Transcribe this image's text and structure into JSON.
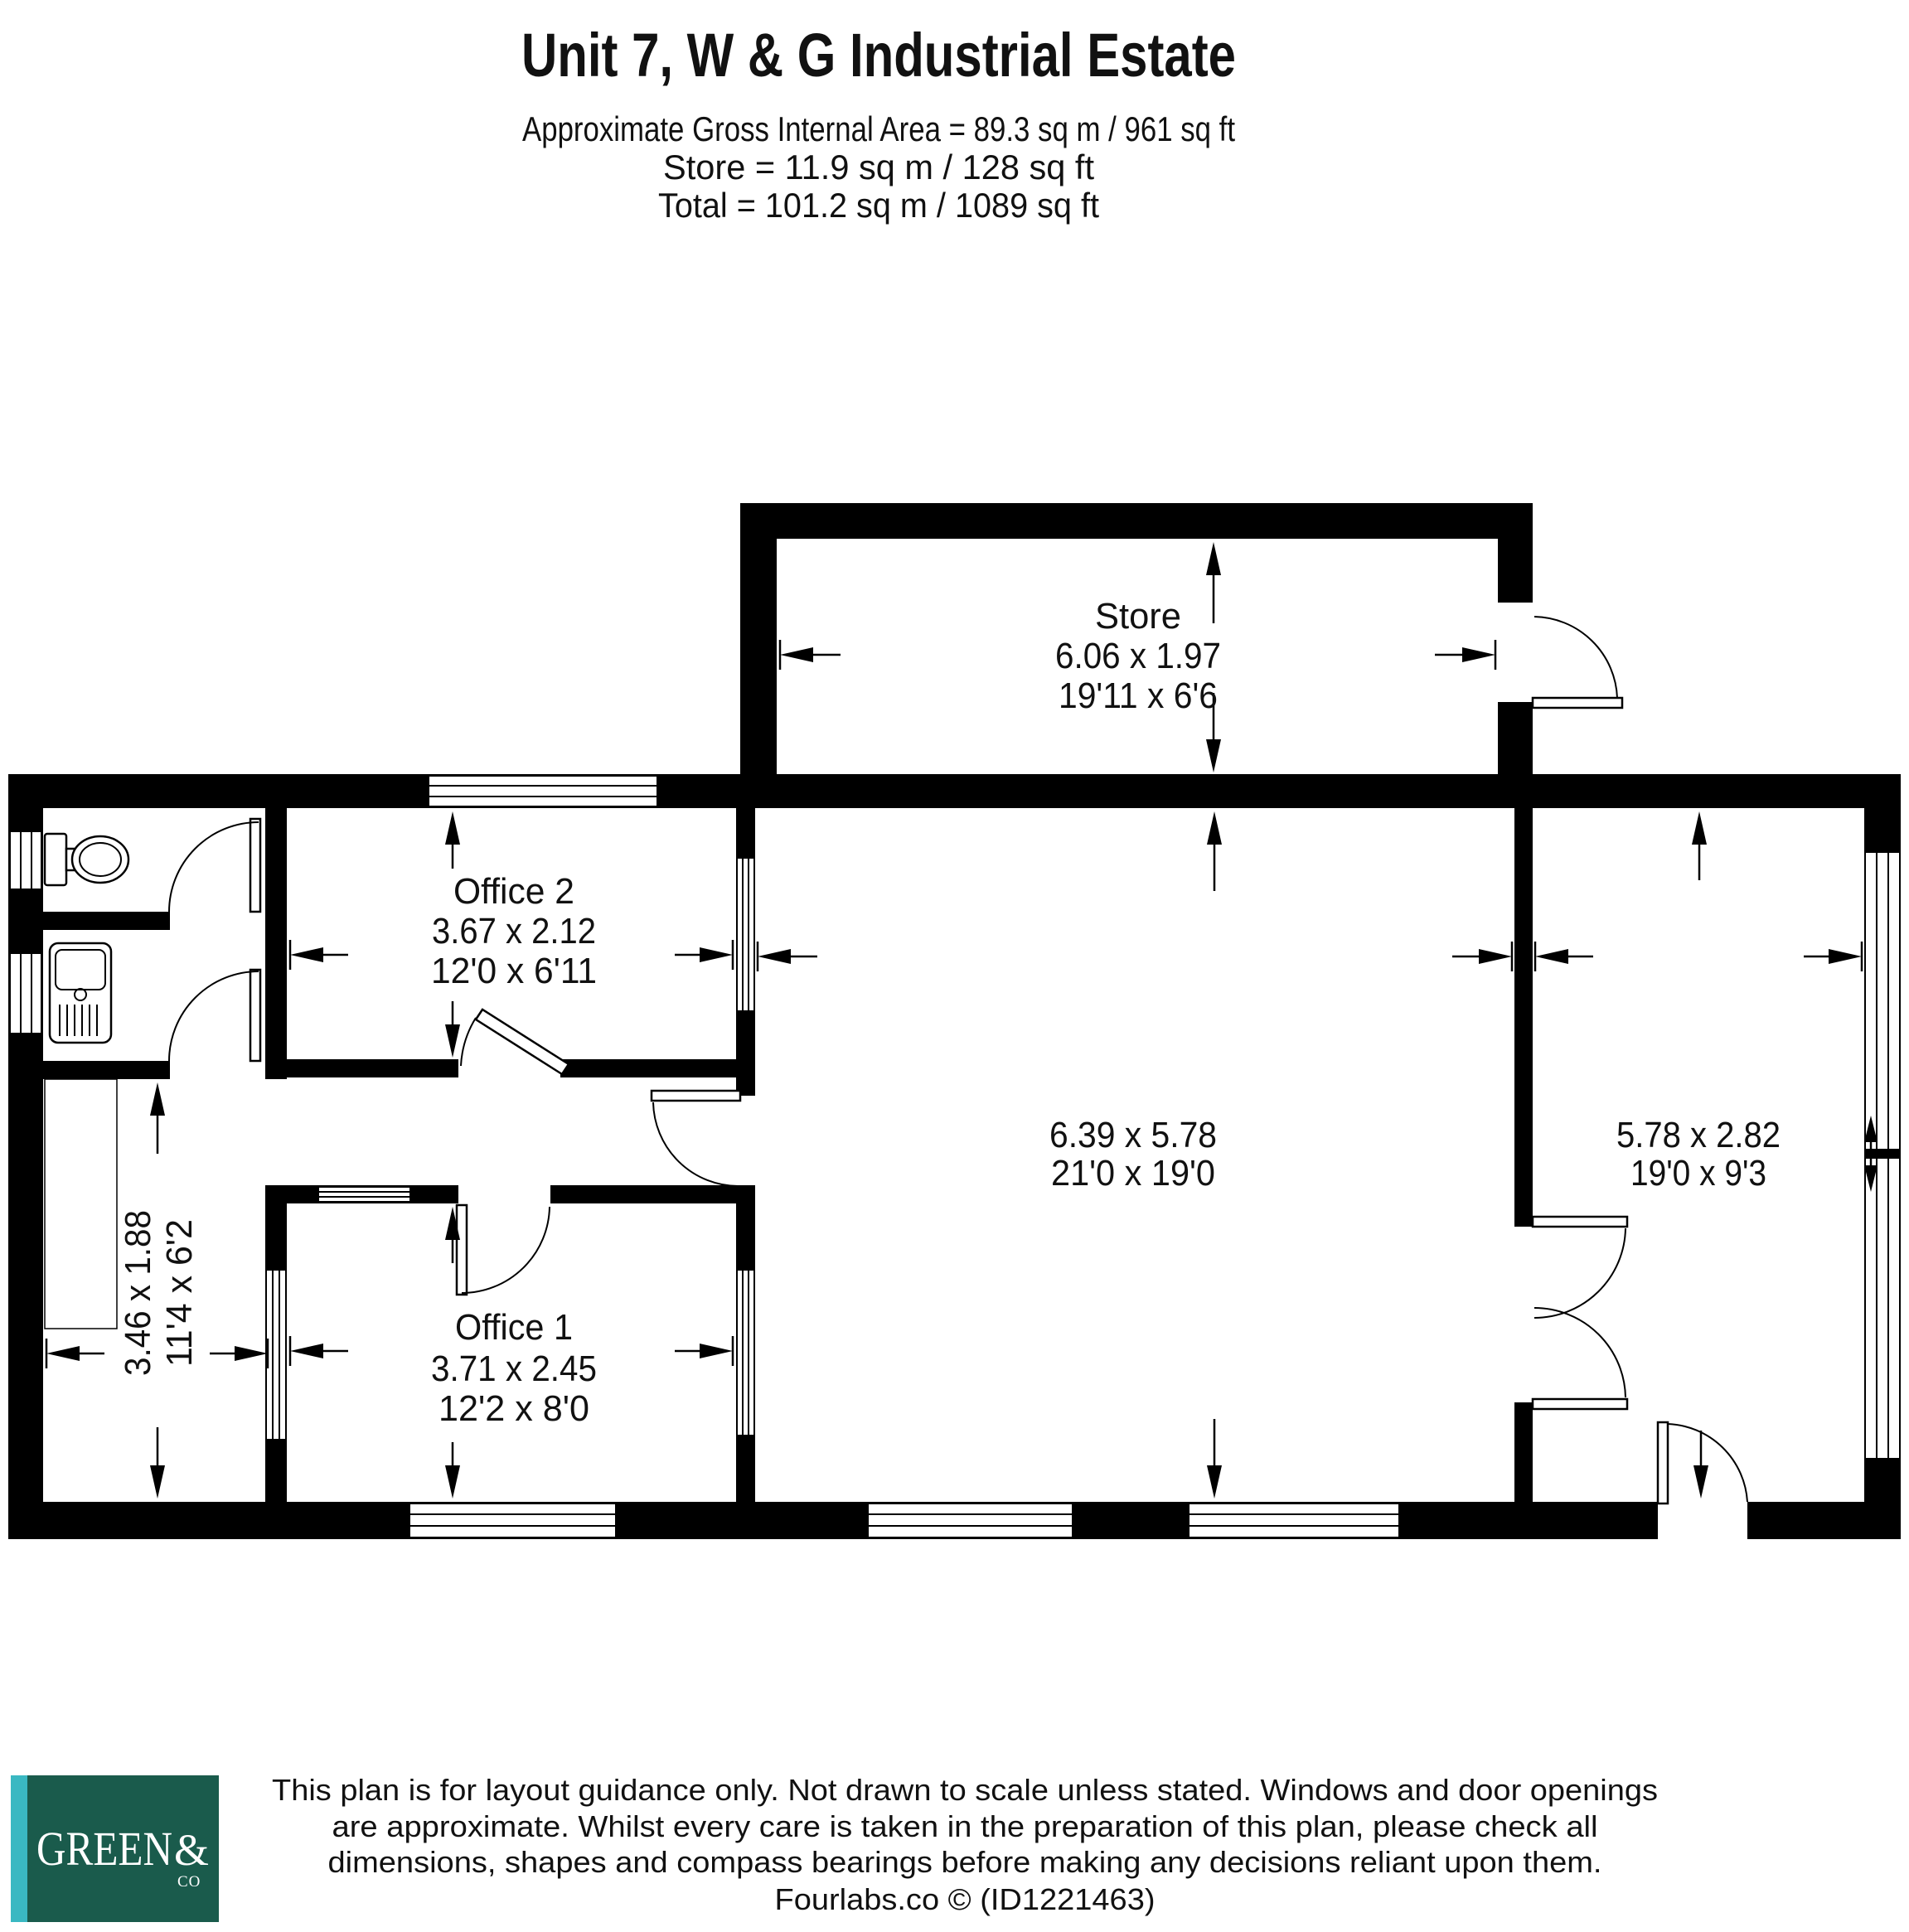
{
  "header": {
    "title": "Unit 7, W & G Industrial Estate",
    "area_line": "Approximate Gross Internal Area = 89.3 sq m / 961 sq ft",
    "store_line": "Store = 11.9 sq m / 128 sq ft",
    "total_line": "Total = 101.2 sq m / 1089 sq ft"
  },
  "rooms": {
    "store": {
      "name": "Store",
      "metric": "6.06 x 1.97",
      "imperial": "19'11 x 6'6"
    },
    "office2": {
      "name": "Office 2",
      "metric": "3.67 x 2.12",
      "imperial": "12'0 x 6'11"
    },
    "office1": {
      "name": "Office 1",
      "metric": "3.71 x 2.45",
      "imperial": "12'2 x 8'0"
    },
    "warehouse": {
      "metric": "6.39 x 5.78",
      "imperial": "21'0 x 19'0"
    },
    "reception": {
      "metric": "5.78 x 2.82",
      "imperial": "19'0 x 9'3"
    },
    "corridor": {
      "metric": "3.46 x 1.88",
      "imperial": "11'4 x 6'2"
    }
  },
  "footer": {
    "disclaimer_line1": "This plan is for layout guidance only. Not drawn to scale unless stated. Windows and door openings",
    "disclaimer_line2": "are approximate. Whilst every care is taken in the preparation of this plan, please check all",
    "disclaimer_line3": "dimensions, shapes and compass bearings before making any decisions reliant upon them.",
    "credit_line": "Fourlabs.co © (ID1221463)",
    "logo": {
      "green_text": "GREEN",
      "ampersand": "&",
      "co_text": "CO",
      "square_color": "#1a5b4c",
      "stripe_color": "#3ab8c2"
    }
  },
  "colors": {
    "wall": "#000000",
    "background": "#ffffff"
  }
}
